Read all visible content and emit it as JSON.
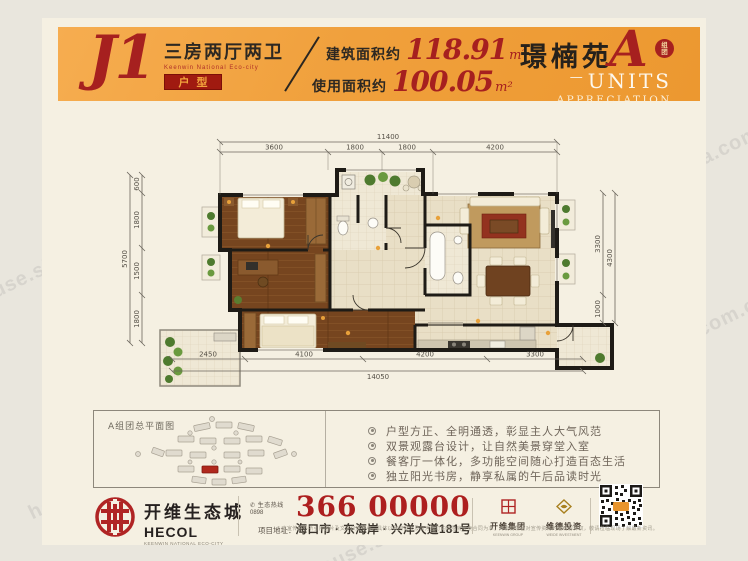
{
  "watermark": "house.sina.com.cn",
  "header": {
    "unit_code": "J1",
    "unit_type": "三房两厅两卫",
    "unit_type_sub": "Keenwin National Eco-city",
    "unit_tag": "户型",
    "area_built_label": "建筑面积约",
    "area_built_value": "118.91",
    "area_built_unit": "m²",
    "area_use_label": "使用面积约",
    "area_use_value": "100.05",
    "area_use_unit": "m²",
    "project_name": "璟楠苑",
    "block_letter": "A",
    "block_badge_top": "组",
    "block_badge_bottom": "团",
    "units_dash": "—",
    "subtitle_units": "UNITS",
    "subtitle_appreciation": "APPRECIATION"
  },
  "plan": {
    "dims": {
      "top_total": "11400",
      "top_segments": [
        "3600",
        "1800",
        "1800",
        "4200"
      ],
      "bottom_total": "14050",
      "bottom_segments": [
        "2450",
        "4100",
        "4200",
        "3300"
      ],
      "left_total": "5700",
      "left_segments": [
        "600",
        "1800",
        "1500",
        "1800"
      ],
      "right_total": "4300",
      "right_segments": [
        "3300",
        "1000"
      ]
    }
  },
  "site_plan": {
    "title": "A组团总平面图"
  },
  "features": {
    "items": [
      "户型方正、全明通透，彰显主人大气风范",
      "双景观露台设计，让自然美景穿堂入室",
      "餐客厅一体化，多功能空间随心打造百态生活",
      "独立阳光书房，静享私属的午后品读时光"
    ]
  },
  "footer": {
    "brand_cn": "开维生态城",
    "brand_en": "HECOL",
    "brand_sub": "KEENWIN NATIONAL ECO-CITY",
    "hotline_label": "生态热线",
    "hotline_area": "0898",
    "phone": "366 00000",
    "address_label": "项目地址：",
    "address": "海口市 · 东海岸 · 兴洋大道181号",
    "group1_name": "开维集团",
    "group1_sub": "KEENWIN GROUP",
    "group2_name": "维德投资",
    "group2_sub": "WEIDE INVESTMENT",
    "disclaimer": "* 本宣传资料所引用图片及文字仅供参考，具体以政府批文及双方签订的商品房买卖合同为准，开发商保留对宣传资料的最终解释权，敬请莅临现场了解最新资讯。"
  }
}
